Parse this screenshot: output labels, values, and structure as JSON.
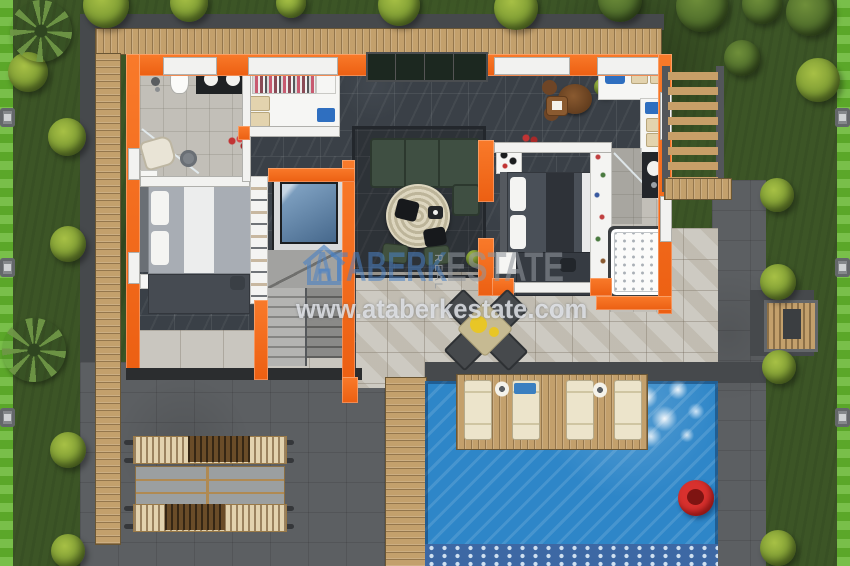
{
  "watermark": {
    "logo_icon": "house-outline-icon",
    "brand_primary": "ATABERK",
    "brand_vertical": "REAL",
    "brand_secondary": "ESTATE",
    "website": "www.ataberkestate.com",
    "brand_primary_color": "#4a82c4",
    "brand_secondary_color": "#90969c",
    "website_color": "#e6e9ee"
  },
  "scene": {
    "type": "top-down 3D architectural floor plan render of a villa",
    "wall_accent_color": "#f2691d",
    "pool_color": "#2e86c8",
    "float_color": "#d63430",
    "areas": [
      "garden with round trees and palms",
      "wooden decks",
      "villa interior: two bedrooms, two bathrooms, walk-in closet, kitchen, dining, living lounge, glass elevator, staircase",
      "stone patio with outdoor dining set",
      "swimming pool with sun loungers and red swim ring",
      "timber pergola seating structure",
      "paved driveway and garden paths"
    ]
  }
}
